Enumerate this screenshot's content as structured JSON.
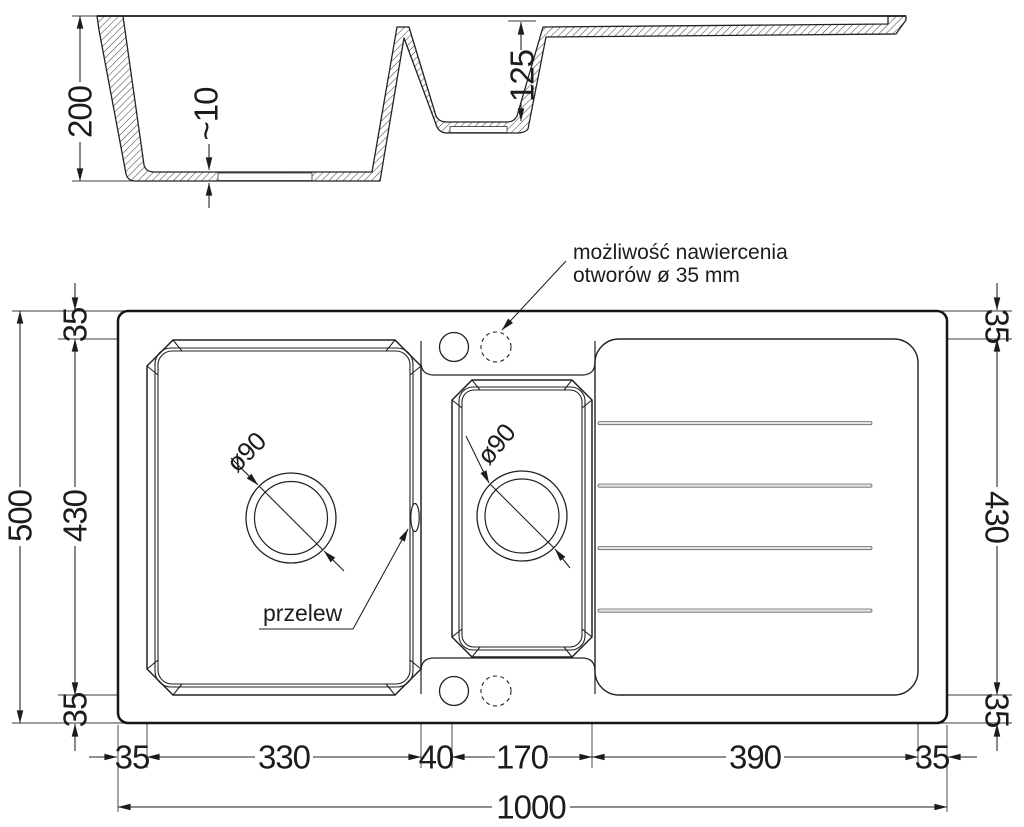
{
  "section": {
    "depth_main": "200",
    "bottom_thickness": "~10",
    "depth_small": "125"
  },
  "plan": {
    "annotation": {
      "line1": "możliwość nawiercenia",
      "line2": "otworów ø 35 mm"
    },
    "overflow": "przelew",
    "drain_main": "ø90",
    "drain_small": "ø90",
    "left": {
      "total": "500",
      "inner": "430",
      "top": "35",
      "bottom": "35"
    },
    "right": {
      "inner": "430",
      "top": "35",
      "bottom": "35"
    },
    "bottom": {
      "left_rim": "35",
      "main_bowl": "330",
      "divider": "40",
      "small_bowl": "170",
      "drainer": "390",
      "right_rim": "35",
      "total": "1000"
    }
  }
}
